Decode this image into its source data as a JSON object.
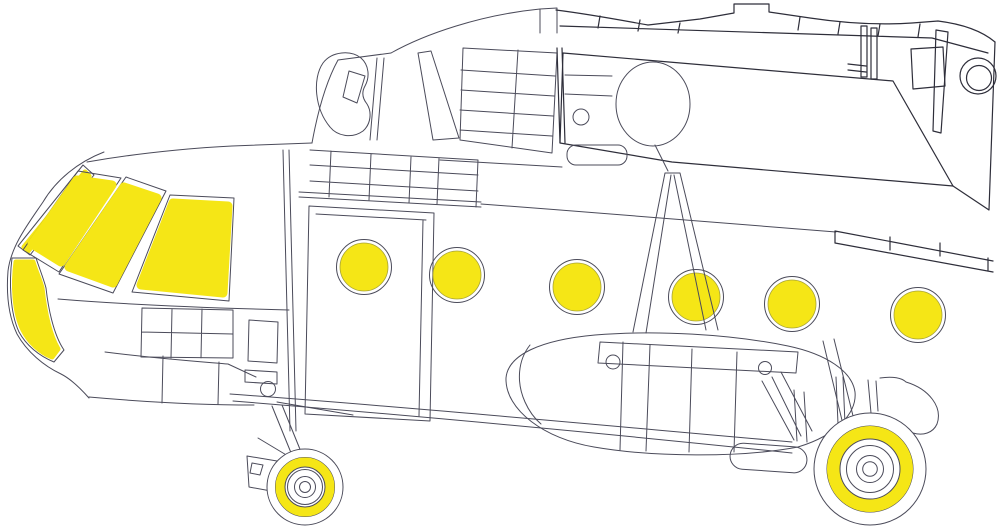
{
  "figure": {
    "kind": "helicopter-paint-mask-placement-diagram",
    "canvas": {
      "width": 1000,
      "height": 527,
      "background": "#ffffff"
    },
    "palette": {
      "mask_yellow": "#F5E616",
      "mask_edge": "#a7a336",
      "line": "#4b4b5a",
      "line_dark": "#2e2e3a",
      "fill": "#ffffff"
    }
  },
  "drawing": {
    "layers": [
      {
        "name": "airframe-lines",
        "shapes": [
          {
            "el": "path",
            "name": "nose-outline",
            "class": "ln",
            "d": "M104,152 C78,162 56,180 43,202 C28,224 11,246 8,271 C6,296 9,317 17,334 C27,352 44,366 61,374 C71,379 81,389 89,398"
          },
          {
            "el": "path",
            "name": "canopy-roofline",
            "class": "ln",
            "d": "M87,162 C150,151 210,147 232,146 L312,143"
          },
          {
            "el": "path",
            "name": "belt-line",
            "class": "ln",
            "d": "M58,299 C130,305 210,308 289,310"
          },
          {
            "el": "path",
            "name": "nose-lower-band",
            "class": "ln",
            "d": "M105,352 C160,359 205,362 228,364 L256,377 M89,397 C145,402 205,405 254,405 M163,356 L162,403 M219,362 L218,404"
          },
          {
            "el": "path",
            "name": "avionics-panel-grid",
            "class": "ln",
            "d": "M142,308 L233,310 M142,332 L233,334 M141,357 L233,358 M142,308 L141,357 M172,309 L171,358 M202,309 L201,358 M233,310 L233,358"
          },
          {
            "el": "path",
            "name": "cockpit-bulkhead",
            "class": "ln",
            "d": "M283,150 L290,431 M289,150 L296,431"
          },
          {
            "el": "path",
            "name": "nose-side-panels",
            "class": "ln",
            "d": "M249,320 L278,322 L277,363 L248,361 Z M245,370 L277,372 L277,384 L245,382 Z"
          },
          {
            "el": "circle",
            "name": "landing-light",
            "class": "ln",
            "cx": 268,
            "cy": 389,
            "r": 7.5
          },
          {
            "el": "path",
            "name": "nose-gear-strut",
            "class": "ln",
            "d": "M277,402 L353,415 M272,406 L298,470 M282,405 L308,469 M258,438 L298,462 M247,456 L277,461 L271,491 L249,487 Z M252,463 L263,465 L260,475 L250,473 Z"
          },
          {
            "el": "path",
            "name": "cabin-door",
            "class": "ln",
            "d": "M309,206 L434,213 L430,421 L305,414 Z M316,214 L426,220 M423,220 L419,416"
          },
          {
            "el": "path",
            "name": "door-rail",
            "class": "ln",
            "d": "M299,192 L481,202 M299,197 L481,207"
          },
          {
            "el": "path",
            "name": "roof-panel-grid",
            "class": "ln",
            "d": "M310,150 L478,160 M310,165 L478,175 M310,181 L478,191 M331,151 L329,197 M371,154 L369,200 M411,157 L409,203 M439,158 L437,204 M478,160 L476,207"
          },
          {
            "el": "path",
            "name": "roof-rail-right",
            "class": "ln",
            "d": "M440,160 L562,167"
          },
          {
            "el": "path",
            "name": "cabin-roofline",
            "class": "ln",
            "d": "M481,204 C600,213 720,222 836,232"
          },
          {
            "el": "path",
            "name": "cowl-front-edge",
            "class": "ln",
            "d": "M312,143 C318,110 327,80 338,60 M338,60 L391,53 M377,58 L370,140 M384,58 L377,140"
          },
          {
            "el": "path",
            "name": "intake-ear-fairing",
            "class": "ln",
            "d": "M323,63 C332,51 351,50 361,58 C369,65 370,77 365,86 C361,93 363,99 367,104 C372,112 371,124 363,131 C352,139 337,136 330,127 C315,109 312,79 323,63 Z M349,71 L365,76 L357,103 L343,97 Z"
          },
          {
            "el": "path",
            "name": "cowl-trapezoid-panel",
            "class": "ln",
            "d": "M418,53 L431,51 L459,138 L433,140 Z"
          },
          {
            "el": "path",
            "name": "engine-deck-grid-panel",
            "class": "ln",
            "d": "M463,48 L557,53 L552,153 L460,140 Z M518,50 L512,148 M461,70 L555,76 M461,90 L554,96 M460,110 L553,116 M460,130 L552,136"
          },
          {
            "el": "path",
            "name": "roof-peak",
            "class": "ln",
            "d": "M391,53 C425,34 480,15 540,9 M540,33 L540,9 L557,8 L557,33"
          }
        ]
      },
      {
        "name": "overlay-rear-section",
        "shapes": [
          {
            "el": "path",
            "name": "tail-section-panel",
            "class": "fillw",
            "d": "M563,53 L893,81 L953,186 L672,162 L560,143 Z"
          },
          {
            "el": "path",
            "name": "overlay-left-edge",
            "class": "lnd",
            "d": "M557,48 L560,143 M562,48 L565,143"
          },
          {
            "el": "path",
            "name": "overlay-top-outline",
            "class": "lnd",
            "d": "M556,10 C595,15 625,21 648,25 L700,19 L734,13 L734,4 L769,4 L769,12 L810,18 C850,24 882,25 912,23 L938,21 C962,24 982,31 995,42"
          },
          {
            "el": "path",
            "name": "overlay-top-band",
            "class": "lnd",
            "d": "M560,26 L932,38 L988,53 M600,16 L598,28 M640,20 L638,31 M680,23 L678,33 M800,17 L798,30 M840,22 L838,34 M880,24 L878,36 M920,24 L918,37"
          },
          {
            "el": "path",
            "name": "hatch-strips",
            "class": "lnd",
            "d": "M861,26 L867,26 L867,77 L861,77 Z M871,28 L877,28 L877,79 L871,79 Z M848,64 L866,66 M848,70 L866,72"
          },
          {
            "el": "path",
            "name": "long-strip",
            "class": "lnd",
            "d": "M936,30 L948,32 L941,133 L933,131 Z"
          },
          {
            "el": "path",
            "name": "access-square",
            "class": "lnd",
            "d": "M911,49 L943,47 L945,86 L913,89 Z"
          },
          {
            "el": "circle",
            "name": "tail-window-outer",
            "class": "lnd",
            "cx": 978,
            "cy": 76,
            "r": 18
          },
          {
            "el": "circle",
            "name": "tail-window-inner",
            "class": "lnd",
            "cx": 979,
            "cy": 78,
            "r": 12.5
          },
          {
            "el": "path",
            "name": "overlay-right-edge",
            "class": "lnd",
            "d": "M995,42 L989,210 L953,186"
          },
          {
            "el": "path",
            "name": "tailboom-band",
            "class": "lnd",
            "d": "M835,231 L993,261 M835,243 L993,272 M835,231 L835,243 M890,237 L890,250 M940,243 L940,256 M988,258 L988,271"
          }
        ]
      },
      {
        "name": "rotor-hub",
        "shapes": [
          {
            "el": "ellipse",
            "name": "rotor-hub-base",
            "class": "fillwl",
            "cx": 653,
            "cy": 104,
            "rx": 37,
            "ry": 42
          },
          {
            "el": "circle",
            "name": "hub-small-port",
            "class": "ln",
            "cx": 581,
            "cy": 117,
            "r": 8
          },
          {
            "el": "rect",
            "name": "cowl-rear-bar",
            "class": "ln",
            "x": 567,
            "y": 145,
            "width": 60,
            "height": 20,
            "rx": 9
          },
          {
            "el": "path",
            "name": "hub-details",
            "class": "ln",
            "d": "M655,145 L668,171 M565,75 L612,76 M565,94 L612,96"
          }
        ]
      },
      {
        "name": "fuel-tank",
        "shapes": [
          {
            "el": "path",
            "name": "fuel-tank-outline",
            "class": "fillwl",
            "d": "M506,378 C508,355 540,340 595,335 C655,330 730,334 788,346 C826,354 852,371 855,392 C857,412 838,435 798,447 C740,458 652,457 594,447 C545,439 505,410 506,378 Z"
          },
          {
            "el": "path",
            "name": "tank-top-strip",
            "class": "ln",
            "d": "M600,342 L798,352 L796,373 L598,363 Z"
          },
          {
            "el": "circle",
            "name": "tank-filler-cap-1",
            "class": "ln",
            "cx": 613,
            "cy": 362,
            "r": 7
          },
          {
            "el": "circle",
            "name": "tank-filler-cap-2",
            "class": "ln",
            "cx": 765,
            "cy": 368,
            "r": 6.5
          },
          {
            "el": "path",
            "name": "tank-panel-lines",
            "class": "ln",
            "d": "M623,342 L620,450 M650,345 L646,451 M692,349 L689,452 M737,352 L734,452 M530,345 C518,360 516,382 525,402 C529,411 534,418 541,424 M823,341 L846,437 M834,339 L856,428"
          }
        ]
      },
      {
        "name": "belly-lines",
        "shapes": [
          {
            "el": "path",
            "name": "belly-line-upper",
            "class": "ln",
            "d": "M230,394 C420,408 610,426 792,442"
          },
          {
            "el": "path",
            "name": "belly-line-lower",
            "class": "ln",
            "d": "M233,401 C420,416 610,434 792,453"
          }
        ]
      },
      {
        "name": "rear-gear-lines",
        "shapes": [
          {
            "el": "path",
            "name": "clamshell-door-lines",
            "class": "ln",
            "d": "M762,381 L794,440 M772,377 L801,436 M781,372 L812,431 M794,390 L797,441 M804,392 L807,442"
          },
          {
            "el": "path",
            "name": "main-gear-strut",
            "class": "ln",
            "d": "M836,377 L838,424 M843,377 L845,424 M868,380 L871,413 M876,381 L878,411"
          },
          {
            "el": "path",
            "name": "gear-fairing",
            "class": "ln",
            "d": "M880,378 C893,376 902,378 906,382 C929,389 943,407 937,424 C933,433 923,436 913,433"
          },
          {
            "el": "rect",
            "name": "exhaust-pill",
            "class": "ln",
            "x": 730,
            "y": 445,
            "width": 77,
            "height": 26,
            "rx": 13,
            "transform": "rotate(4 768 458)"
          }
        ]
      },
      {
        "name": "wheels",
        "shapes": [
          {
            "el": "circle",
            "name": "nose-wheel-tire",
            "class": "fillwl",
            "cx": 305,
            "cy": 487,
            "r": 38
          },
          {
            "el": "circle",
            "name": "nose-wheel-ring-outer",
            "class": "ln",
            "cx": 305,
            "cy": 487,
            "r": 29.5
          },
          {
            "el": "circle",
            "name": "nose-wheel-mask-ring",
            "class": "maskring",
            "cx": 305,
            "cy": 487,
            "r": 24.75,
            "stroke-width": 9.5
          },
          {
            "el": "circle",
            "name": "nose-wheel-ring-inner",
            "class": "ln",
            "cx": 305,
            "cy": 487,
            "r": 20
          },
          {
            "el": "circle",
            "name": "nose-wheel-hub-1",
            "class": "ln",
            "cx": 305,
            "cy": 487,
            "r": 17.5
          },
          {
            "el": "circle",
            "name": "nose-wheel-hub-2",
            "class": "ln",
            "cx": 305,
            "cy": 487,
            "r": 10.5
          },
          {
            "el": "circle",
            "name": "nose-wheel-hub-3",
            "class": "ln",
            "cx": 305,
            "cy": 487,
            "r": 5.5
          },
          {
            "el": "circle",
            "name": "main-wheel-tire",
            "class": "fillwl",
            "cx": 870,
            "cy": 469,
            "r": 56
          },
          {
            "el": "circle",
            "name": "main-wheel-ring-outer",
            "class": "ln",
            "cx": 870,
            "cy": 469,
            "r": 43
          },
          {
            "el": "circle",
            "name": "main-wheel-mask-ring",
            "class": "maskring",
            "cx": 870,
            "cy": 469,
            "r": 36.5,
            "stroke-width": 13
          },
          {
            "el": "circle",
            "name": "main-wheel-ring-inner",
            "class": "ln",
            "cx": 870,
            "cy": 469,
            "r": 30
          },
          {
            "el": "circle",
            "name": "main-wheel-hub-1",
            "class": "ln",
            "cx": 870,
            "cy": 469,
            "r": 23.5
          },
          {
            "el": "circle",
            "name": "main-wheel-hub-2",
            "class": "ln",
            "cx": 870,
            "cy": 469,
            "r": 13.5
          },
          {
            "el": "circle",
            "name": "main-wheel-hub-3",
            "class": "ln",
            "cx": 870,
            "cy": 469,
            "r": 7.3
          }
        ]
      },
      {
        "name": "canopy-masks",
        "shapes": [
          {
            "el": "polygon",
            "name": "canopy-strip-frame",
            "class": "frame",
            "points": "18,246 83,165 94,175 30,255"
          },
          {
            "el": "polygon",
            "name": "canopy-strip-mask",
            "class": "maskstroke-thin",
            "points": "24,247 85,172 89,176 28,251"
          },
          {
            "el": "polygon",
            "name": "windshield-frame-1",
            "class": "frame",
            "points": "78,171 121,178 59,272 23,250"
          },
          {
            "el": "polygon",
            "name": "windshield-mask-1",
            "class": "maskstroke",
            "points": "77,180 112,185 61,262 32,244"
          },
          {
            "el": "polygon",
            "name": "windshield-frame-2",
            "class": "frame",
            "points": "126,177 166,191 113,293 59,274"
          },
          {
            "el": "polygon",
            "name": "windshield-mask-2",
            "class": "maskstroke",
            "points": "124,187 157,198 113,283 69,267"
          },
          {
            "el": "polygon",
            "name": "windshield-frame-3",
            "class": "frame",
            "points": "170,195 234,198 229,301 132,292"
          },
          {
            "el": "polygon",
            "name": "windshield-mask-3",
            "class": "maskstroke",
            "points": "173,203 228,206 223,293 141,285"
          },
          {
            "el": "path",
            "name": "chin-window-frame",
            "class": "frame",
            "d": "M12,258 L36,258 C40,270 44,280 46,288 C48,306 53,334 64,350 L54,362 C39,356 26,345 19,332 C10,313 9,282 12,258 Z"
          },
          {
            "el": "path",
            "name": "chin-window-mask",
            "class": "maskstroke-thin",
            "d": "M16,262 L33,262 C36,272 40,280 42,288 C44,306 48,332 58,349 L52,357 C40,352 29,342 23,330 C14,312 13,284 16,262 Z"
          }
        ]
      },
      {
        "name": "porthole-masks",
        "shapes": [
          {
            "el": "circle",
            "name": "porthole-frame-1",
            "class": "ln",
            "cx": 364,
            "cy": 267,
            "r": 27.5
          },
          {
            "el": "circle",
            "name": "porthole-mask-1",
            "class": "mask",
            "cx": 364,
            "cy": 267,
            "r": 24
          },
          {
            "el": "circle",
            "name": "porthole-frame-2",
            "class": "ln",
            "cx": 457,
            "cy": 275,
            "r": 27.5
          },
          {
            "el": "circle",
            "name": "porthole-mask-2",
            "class": "mask",
            "cx": 457,
            "cy": 275,
            "r": 24
          },
          {
            "el": "circle",
            "name": "porthole-frame-3",
            "class": "ln",
            "cx": 577,
            "cy": 287,
            "r": 27.5
          },
          {
            "el": "circle",
            "name": "porthole-mask-3",
            "class": "mask",
            "cx": 577,
            "cy": 287,
            "r": 24
          },
          {
            "el": "circle",
            "name": "porthole-frame-4",
            "class": "ln",
            "cx": 696,
            "cy": 297,
            "r": 27.5
          },
          {
            "el": "circle",
            "name": "porthole-mask-4",
            "class": "mask",
            "cx": 696,
            "cy": 297,
            "r": 24
          },
          {
            "el": "circle",
            "name": "porthole-frame-5",
            "class": "ln",
            "cx": 792,
            "cy": 304,
            "r": 27.5
          },
          {
            "el": "circle",
            "name": "porthole-mask-5",
            "class": "mask",
            "cx": 792,
            "cy": 304,
            "r": 24
          },
          {
            "el": "circle",
            "name": "porthole-frame-6",
            "class": "ln",
            "cx": 918,
            "cy": 315,
            "r": 27.5
          },
          {
            "el": "circle",
            "name": "porthole-mask-6",
            "class": "mask",
            "cx": 918,
            "cy": 315,
            "r": 24
          }
        ]
      },
      {
        "name": "antenna-mast",
        "shapes": [
          {
            "el": "path",
            "name": "antenna-mast-legs",
            "class": "ln",
            "d": "M665,173 L633,332 M671,175 L646,333 M674,175 L706,330 M680,173 L718,330 M665,173 L680,173"
          }
        ]
      }
    ]
  }
}
